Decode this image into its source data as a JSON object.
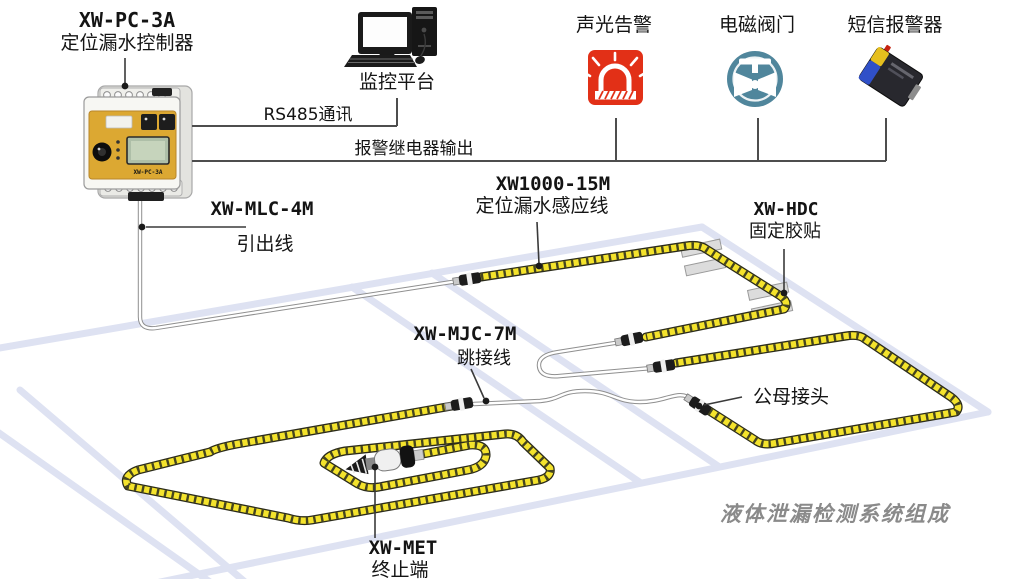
{
  "title": "液体泄漏检测系统组成",
  "controller": {
    "model": "XW-PC-3A",
    "name": "定位漏水控制器"
  },
  "monitor": {
    "label": "监控平台"
  },
  "links": {
    "rs485": "RS485通讯",
    "relay": "报警继电器输出"
  },
  "outputs": [
    {
      "label": "声光告警"
    },
    {
      "label": "电磁阀门"
    },
    {
      "label": "短信报警器"
    }
  ],
  "labels": {
    "lead": {
      "model": "XW-MLC-4M",
      "name": "引出线"
    },
    "sensing": {
      "model": "XW1000-15M",
      "name": "定位漏水感应线"
    },
    "tape": {
      "model": "XW-HDC",
      "name": "固定胶贴"
    },
    "jumper": {
      "model": "XW-MJC-7M",
      "name": "跳接线"
    },
    "connector": {
      "name": "公母接头"
    },
    "terminator": {
      "model": "XW-MET",
      "name": "终止端"
    }
  },
  "colors": {
    "cable_yellow": "#f4e32c",
    "floor_line": "#dee2f2",
    "alarm_red": "#e23017",
    "valve_teal": "#50869c",
    "sms_blue": "#3050c8",
    "title_gray": "#8a8a8a"
  }
}
